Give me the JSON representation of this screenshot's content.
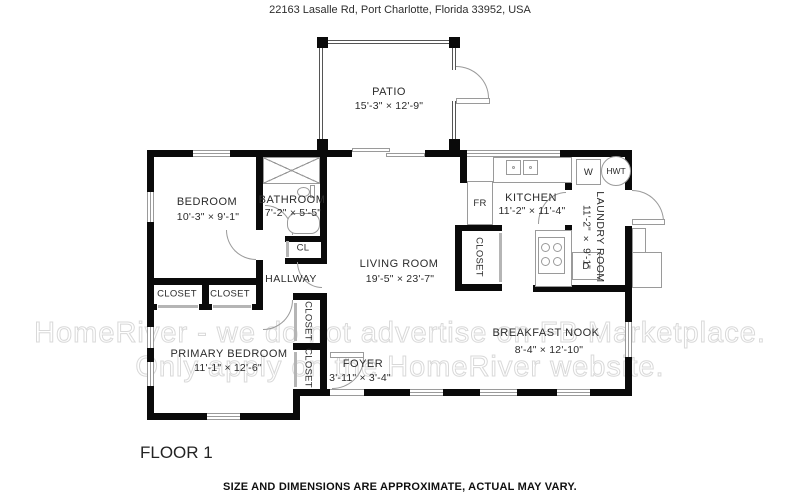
{
  "header": {
    "address": "22163 Lasalle Rd, Port Charlotte, Florida 33952, USA"
  },
  "watermark": {
    "line1": "HomeRiver - we do not advertise on FB Marketplace.",
    "line2": "Only apply on the HomeRiver website."
  },
  "floor_label": "FLOOR 1",
  "footer": {
    "disclaimer": "SIZE AND DIMENSIONS ARE APPROXIMATE, ACTUAL MAY VARY."
  },
  "rooms": {
    "patio": {
      "name": "PATIO",
      "dims": "15'-3\" × 12'-9\""
    },
    "bedroom": {
      "name": "BEDROOM",
      "dims": "10'-3\" × 9'-1\""
    },
    "bathroom": {
      "name": "BATHROOM",
      "dims": "7'-2\" × 5'-5\""
    },
    "kitchen": {
      "name": "KITCHEN",
      "dims": "11'-2\" × 11'-4\""
    },
    "laundry": {
      "name": "LAUNDRY ROOM",
      "dims": "11'-2\" × 9'-1\""
    },
    "living": {
      "name": "LIVING ROOM",
      "dims": "19'-5\" × 23'-7\""
    },
    "hallway": {
      "name": "HALLWAY"
    },
    "primary": {
      "name": "PRIMARY BEDROOM",
      "dims": "11'-1\" × 12'-6\""
    },
    "foyer": {
      "name": "FOYER",
      "dims": "3'-11\" × 3'-4\""
    },
    "breakfast": {
      "name": "BREAKFAST NOOK",
      "dims": "8'-4\" × 12'-10\""
    }
  },
  "labels": {
    "closet": "CLOSET",
    "closet_small": "CL",
    "fridge": "FR",
    "washer": "W",
    "dryer": "D",
    "water_heater": "HWT"
  },
  "colors": {
    "wall": "#0a0a0a",
    "line": "#9a9a9a",
    "watermark": "#d9d9d9"
  }
}
